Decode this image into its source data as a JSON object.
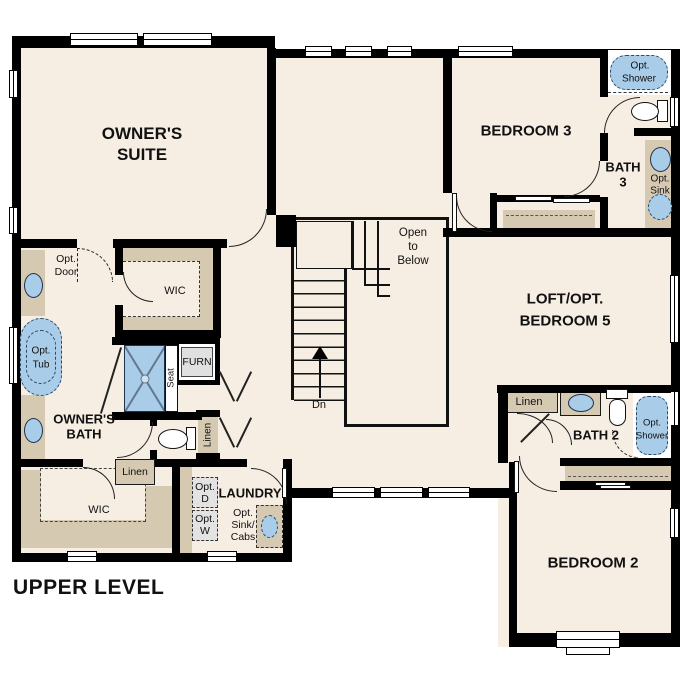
{
  "plan_title": "UPPER LEVEL",
  "rooms": {
    "owners_suite": {
      "line1": "OWNER'S",
      "line2": "SUITE"
    },
    "bedroom3": "BEDROOM 3",
    "bath3": {
      "line1": "BATH",
      "line2": "3"
    },
    "loft": {
      "line1": "LOFT/OPT.",
      "line2": "BEDROOM 5"
    },
    "bedroom2": "BEDROOM 2",
    "bath2": "BATH 2",
    "owners_bath": {
      "line1": "OWNER'S",
      "line2": "BATH"
    },
    "laundry": "LAUNDRY",
    "wic_owner": "WIC",
    "wic_second": "WIC"
  },
  "stairs": {
    "open_to_below": {
      "line1": "Open",
      "line2": "to",
      "line3": "Below"
    },
    "direction": "Dn"
  },
  "closets": {
    "linen_hall": "Linen",
    "linen_entry": "Linen",
    "linen_bath2": "Linen",
    "furnace": "FURN",
    "shower_seat": "Seat"
  },
  "options": {
    "door": {
      "line1": "Opt.",
      "line2": "Door"
    },
    "tub": {
      "line1": "Opt.",
      "line2": "Tub"
    },
    "shower_bath3": {
      "line1": "Opt.",
      "line2": "Shower"
    },
    "sink_bath3": {
      "line1": "Opt.",
      "line2": "Sink"
    },
    "dryer": {
      "line1": "Opt.",
      "line2": "D"
    },
    "washer": {
      "line1": "Opt.",
      "line2": "W"
    },
    "sink_cabs": {
      "line1": "Opt.",
      "line2": "Sink/",
      "line3": "Cabs"
    },
    "shower_bath2": {
      "line1": "Opt.",
      "line2": "Shower"
    }
  },
  "colors": {
    "background": "#ffffff",
    "floor": "#f7eee3",
    "wall": "#000000",
    "cabinetry": "#d6c9b1",
    "fixture_blue": "#a9cce8",
    "fixture_outline": "#1f3350",
    "appliance_gray": "#e3e3e3"
  }
}
